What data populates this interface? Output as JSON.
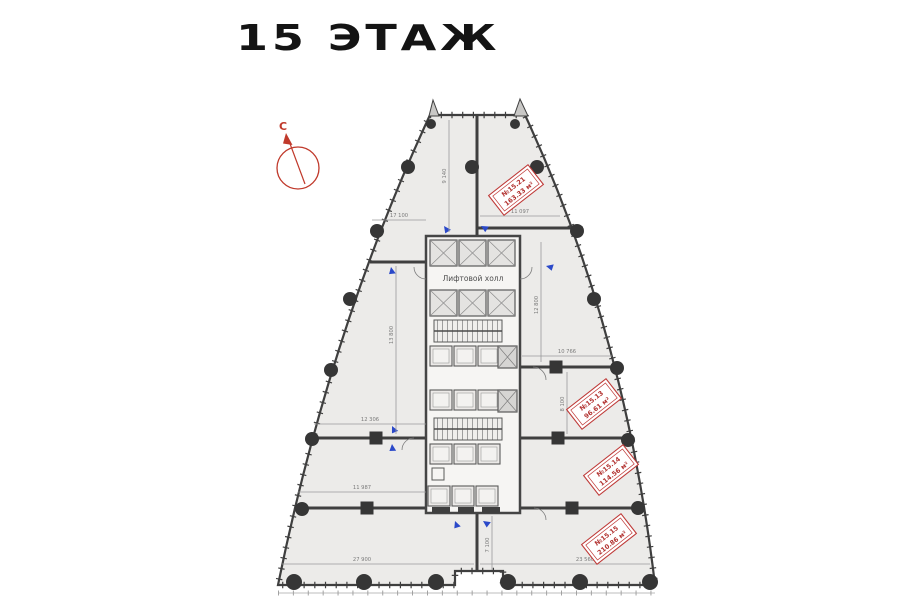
{
  "title": "15 ЭТАЖ",
  "compass": {
    "north_label": "С"
  },
  "plan": {
    "lobby_label": "Лифтовой холл",
    "units": [
      {
        "number": "№15.21",
        "area": "163.33 м²"
      },
      {
        "number": "№15.13",
        "area": "96.61 м²"
      },
      {
        "number": "№15.14",
        "area": "114.56 м²"
      },
      {
        "number": "№15.15",
        "area": "210.86 м²"
      }
    ],
    "dimensions": {
      "d0": "11 097",
      "d1": "17 100",
      "d2": "9 140",
      "d3": "13 800",
      "d4": "12 306",
      "d5": "11 987",
      "d6": "7 100",
      "d7": "27 900",
      "d8": "23 560",
      "d9": "10 766",
      "d10": "8 100",
      "d11": "12 800"
    },
    "colors": {
      "accent_red": "#bf3a38",
      "wall": "#3f3f3f",
      "marker_blue": "#2b49c9",
      "floor": "#ecebe9"
    }
  }
}
